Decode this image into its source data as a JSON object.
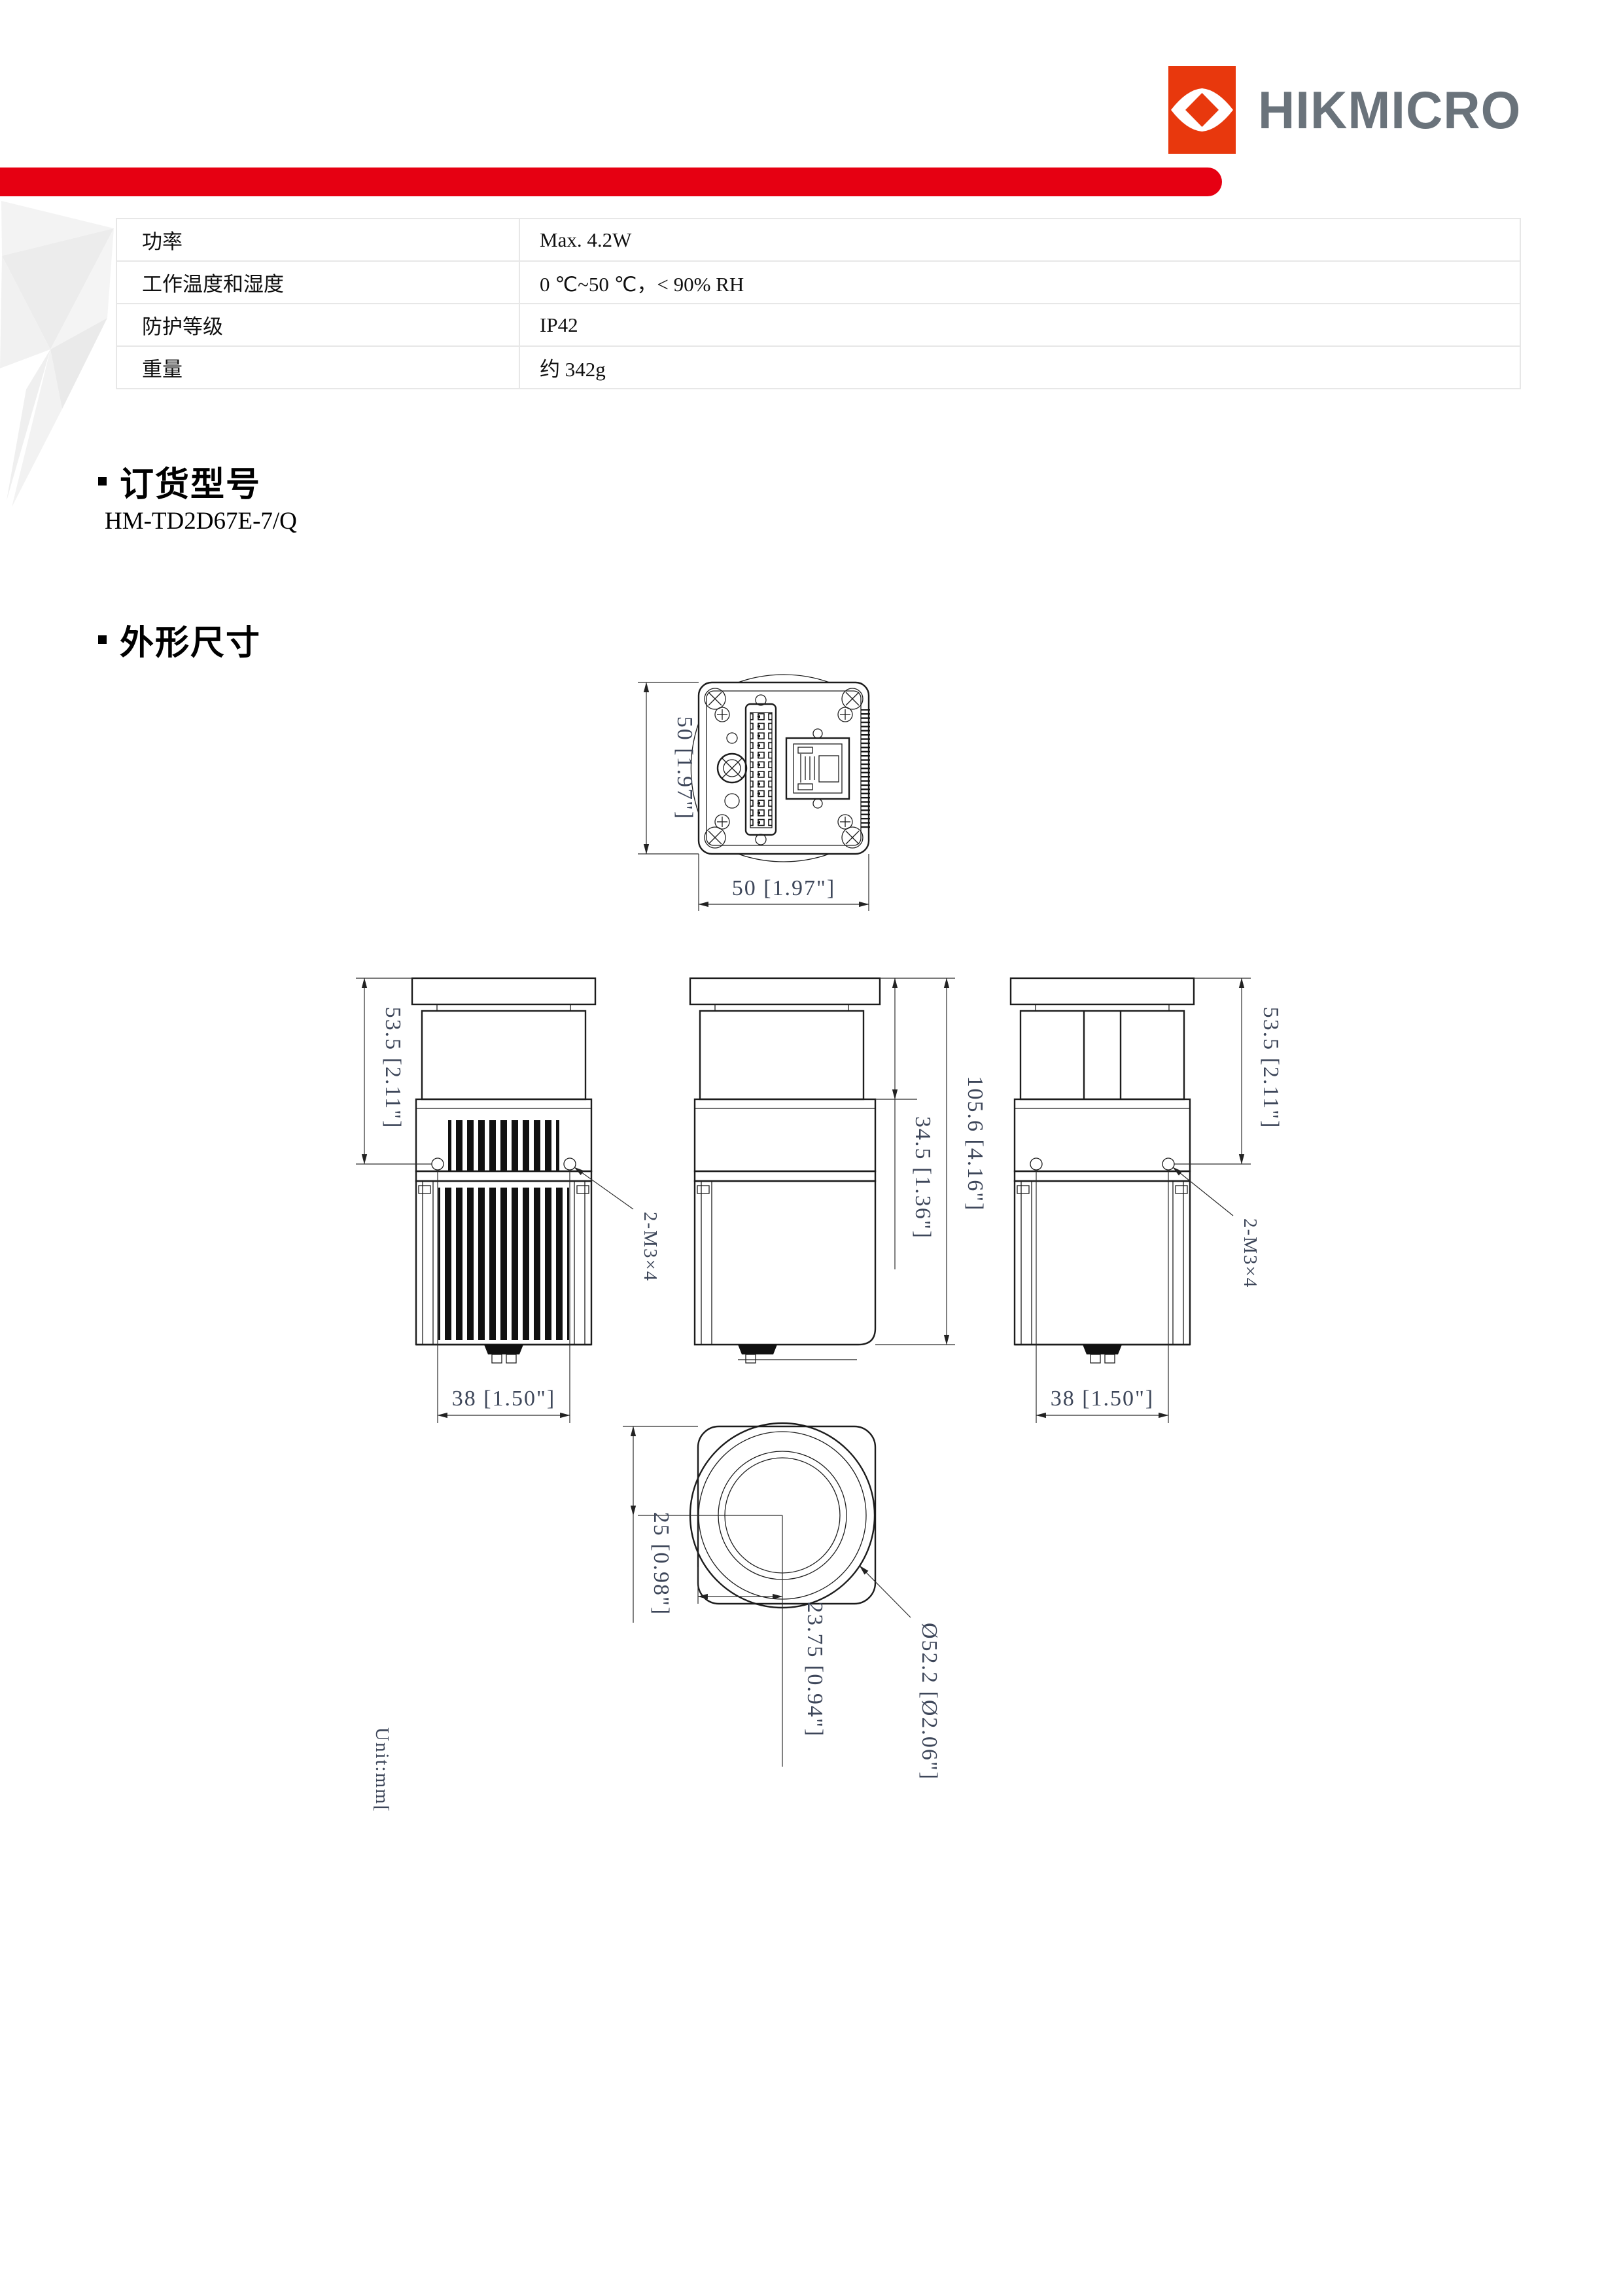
{
  "logo": {
    "wordmark": "HIKMICRO"
  },
  "colors": {
    "banner_red": "#e60012",
    "logo_red": "#e8380d",
    "wordmark_gray": "#6a737b",
    "dim_text": "#3d4659",
    "line_black": "#1c1c1c",
    "watermark_gray": "#ededed"
  },
  "spec_table": {
    "rows": [
      {
        "label": "功率",
        "value": "Max. 4.2W"
      },
      {
        "label": "工作温度和湿度",
        "value": "0 ℃~50 ℃，< 90% RH"
      },
      {
        "label": "防护等级",
        "value": "IP42"
      },
      {
        "label": "重量",
        "value": "约 342g"
      }
    ]
  },
  "sections": {
    "ordering": {
      "title": "订货型号",
      "model": "HM-TD2D67E-7/Q"
    },
    "dimensions": {
      "title": "外形尺寸"
    }
  },
  "drawing": {
    "unit_note": "Unit:mm[",
    "rear_view": {
      "width": "50 [1.97\"]",
      "height": "50 [1.97\"]"
    },
    "side_views": {
      "height_to_holes": "53.5 [2.11\"]",
      "hole_spacing": "38 [1.50\"]",
      "screw_callout": "2-M3×4",
      "front_section_length": "34.5 [1.36\"]",
      "total_length": "105.6 [4.16\"]"
    },
    "front_view": {
      "center_from_top": "25 [0.98\"]",
      "center_from_left": "23.75 [0.94\"]",
      "lens_diameter": "Ø52.2 [Ø2.06\"]"
    }
  }
}
